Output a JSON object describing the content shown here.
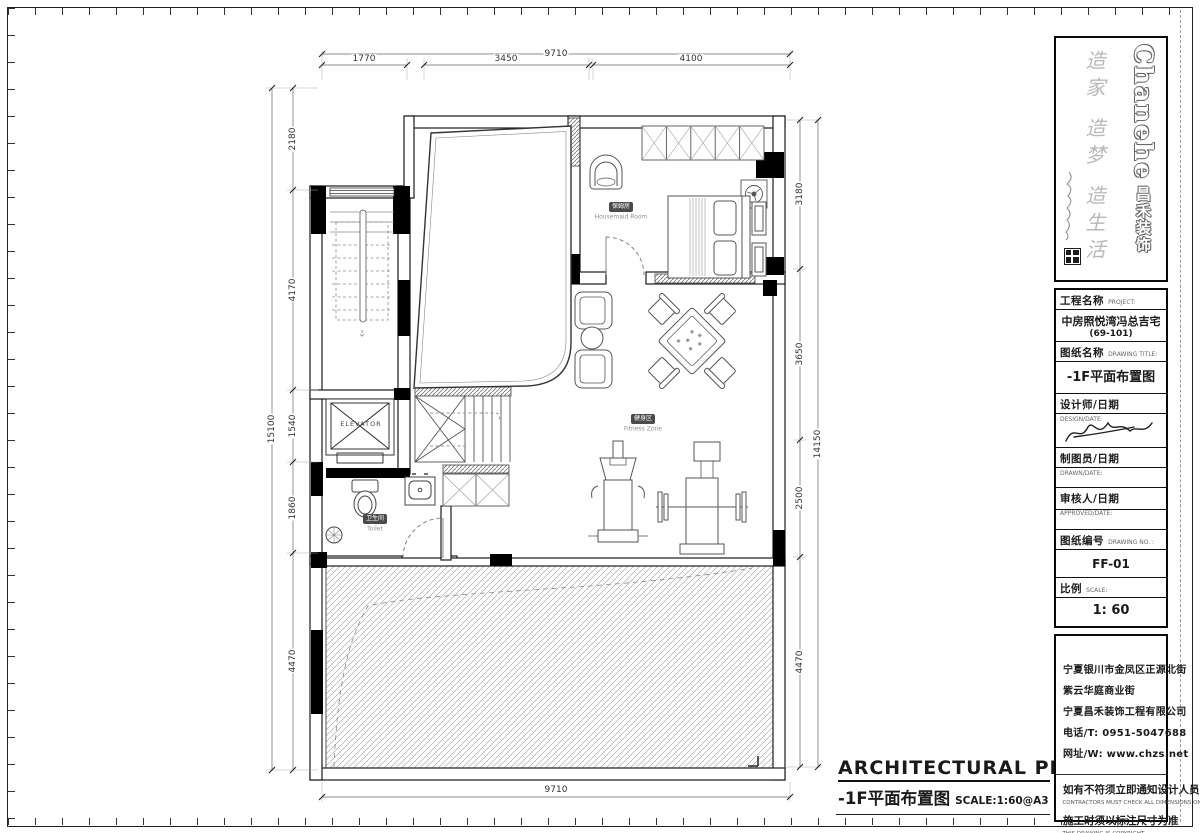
{
  "brand": {
    "name_en": "Chanehe",
    "name_cn": "昌禾装饰",
    "slogan": "造家 造梦 造生活"
  },
  "title_block": {
    "project_label": "工程名称",
    "project_label_en": "PROJECT:",
    "project_value": "中房照悦湾冯总吉宅",
    "project_value2": "(69-101)",
    "drawing_title_label": "图纸名称",
    "drawing_title_label_en": "DRAWING TITLE:",
    "drawing_title_value": "-1F平面布置图",
    "designer_label": "设计师/日期",
    "designer_label_en": "DESIGN/DATE:",
    "drafter_label": "制图员/日期",
    "drafter_label_en": "DRAWN/DATE:",
    "approver_label": "审核人/日期",
    "approver_label_en": "APPROVED/DATE:",
    "drawing_no_label": "图纸编号",
    "drawing_no_label_en": "DRAWING NO. :",
    "drawing_no_value": "FF-01",
    "scale_label": "比例",
    "scale_label_en": "SCALE:",
    "scale_value": "1: 60"
  },
  "company": {
    "address_line1": "宁夏银川市金凤区正源北街",
    "address_line2": "紫云华庭商业街",
    "address_line3": "宁夏昌禾装饰工程有限公司",
    "phone": "电话/T: 0951-5047688",
    "website": "网址/W: www.chzs.net"
  },
  "notes": {
    "note1_cn": "如有不符须立即通知设计人员",
    "note1_en": "CONTRACTORS MUST CHECK ALL DIMENSIONS ON SITE",
    "note2_cn": "施工时须以标注尺寸为准",
    "note2_en": "THIS DRAWING IS COPYRIGHT"
  },
  "plan_caption": {
    "title_en": "ARCHITECTURAL PLAN",
    "title_cn": "-1F平面布置图",
    "scale": "SCALE:1:60@A3"
  },
  "rooms": {
    "housemaid": {
      "cn": "保姆房",
      "en": "Housemaid Room"
    },
    "fitness": {
      "cn": "健身区",
      "en": "Fitness Zone"
    },
    "toilet": {
      "cn": "卫生间",
      "en": "Toilet"
    },
    "elevator": {
      "label": "ELEVATOR"
    }
  },
  "dimensions": {
    "top": {
      "overall": "9710",
      "seg1": "1770",
      "seg2": "3450",
      "seg3": "4100"
    },
    "bottom": {
      "overall": "9710"
    },
    "left": {
      "overall": "15100",
      "seg1": "2180",
      "seg2": "4170",
      "seg3": "1540",
      "seg4": "1860",
      "seg5": "4470"
    },
    "right": {
      "overall": "14150",
      "seg1": "3180",
      "seg2": "3650",
      "seg3": "2500",
      "seg4": "4470"
    }
  },
  "colors": {
    "line": "#1a1a1a",
    "wall_fill": "#000000",
    "hatch": "#8f8f8f",
    "badge_bg": "#4a4a4a"
  }
}
